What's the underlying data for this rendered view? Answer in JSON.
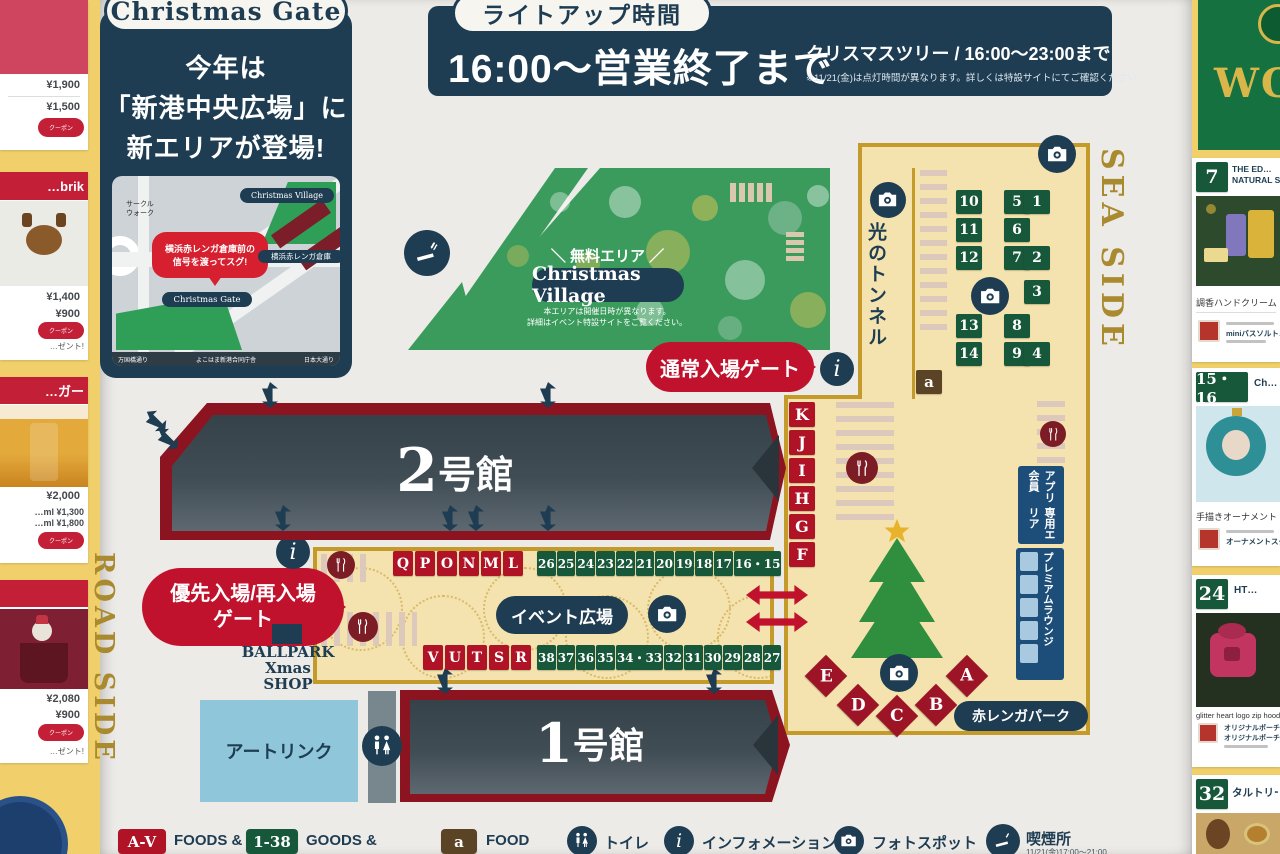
{
  "gate_intro": {
    "pill": "Christmas Gate",
    "line1": "今年は",
    "line2": "「新港中央広場」に",
    "line3": "新エリアが登場!"
  },
  "minimap": {
    "area1": "サークル",
    "area2": "ウォーク",
    "bubble1": "横浜赤レンガ倉庫前の",
    "bubble2": "信号を渡ってスグ!",
    "village": "Christmas Village",
    "warehouse": "横浜赤レンガ倉庫",
    "gate": "Christmas Gate",
    "street_left": "万国橋通り",
    "street_center": "よこはま新港合同庁舎",
    "street_right": "日本大通り"
  },
  "lightup": {
    "pill": "ライトアップ時間",
    "main": "16:00〜営業終了まで",
    "tree": "クリスマスツリー / 16:00〜23:00まで",
    "note": "※11/21(金)は点灯時間が異なります。詳しくは特設サイトにてご確認ください。"
  },
  "village": {
    "free": "＼ 無料エリア ／",
    "name": "Christmas Village",
    "note1": "本エリアは開催日時が異なります。",
    "note2": "詳細はイベント特設サイトをご覧ください。"
  },
  "gates": {
    "normal": "通常入場ゲート",
    "priority1": "優先入場/再入場",
    "priority2": "ゲート"
  },
  "areas": {
    "hall2_num": "2",
    "hall2_suffix": "号館",
    "hall1_num": "1",
    "hall1_suffix": "号館",
    "tunnel": "光のトンネル",
    "sea_side": "SEA SIDE",
    "road_side": "ROAD SIDE",
    "event_plaza": "イベント広場",
    "park": "赤レンガパーク",
    "ballpark1": "BALLPARK",
    "ballpark2": "Xmas SHOP",
    "art_rink": "アートリンク",
    "app1": "アプリ会員",
    "app2": "専用エリア",
    "premium": "プレミアムラウンジ",
    "a_box": "a"
  },
  "booths": {
    "seaside_grid": [
      "10",
      "5",
      "1",
      "11",
      "6",
      "",
      "12",
      "7",
      "2",
      "",
      "",
      "3",
      "13",
      "8",
      "",
      "14",
      "9",
      "4"
    ],
    "kf": [
      "K",
      "J",
      "I",
      "H",
      "G",
      "F"
    ],
    "ql": [
      "Q",
      "P",
      "O",
      "N",
      "M",
      "L"
    ],
    "top_numbers": [
      "26",
      "25",
      "24",
      "23",
      "22",
      "21",
      "20",
      "19",
      "18",
      "17",
      "16・15"
    ],
    "vr": [
      "V",
      "U",
      "T",
      "S",
      "R"
    ],
    "bottom_numbers": [
      "38",
      "37",
      "36",
      "35",
      "34・33",
      "32",
      "31",
      "30",
      "29",
      "28",
      "27"
    ],
    "diamonds": [
      "E",
      "D",
      "C",
      "B",
      "A"
    ]
  },
  "legend": {
    "foods_box": "A-V",
    "foods": "FOODS &",
    "goods_box": "1-38",
    "goods": "GOODS &",
    "food_box": "a",
    "food": "FOOD",
    "toilet": "トイレ",
    "info": "インフォメーション",
    "photo": "フォトスポット",
    "smoking": "喫煙所",
    "smoking_note": "11/21(金)17:00〜21:00"
  },
  "left_panel": {
    "card1": {
      "price1": "¥1,900",
      "price2": "¥1,500",
      "badge": "クーポン"
    },
    "card2": {
      "header": "…brik",
      "price1": "¥1,400",
      "price2": "¥900",
      "badge": "クーポン",
      "note": "…ゼント!"
    },
    "card3": {
      "header": "…ガー",
      "price1": "¥2,000",
      "size1": "…ml ¥1,300",
      "size2": "…ml ¥1,800",
      "badge": "クーポン"
    },
    "card4": {
      "header": "",
      "price1": "¥2,080",
      "price2": "¥900",
      "badge": "クーポン",
      "note": "…ゼント!"
    }
  },
  "right_panel": {
    "world_header": "WO",
    "cards": [
      {
        "num": "7",
        "title1": "THE ED…",
        "title2": "NATURAL S…",
        "caption": "調香ハンドクリーム",
        "logo_text": "miniバスソルト…",
        "logo_text2": ""
      },
      {
        "num": "15・16",
        "title1": "Ch…",
        "title2": "",
        "caption": "手描きオーナメント",
        "logo_text": "オーナメントスタン…",
        "logo_text2": ""
      },
      {
        "num": "24",
        "title1": "HT…",
        "title2": "",
        "caption": "glitter heart logo zip hood…",
        "logo_text": "オリジナルポーチ、",
        "logo_text2": "オリジナルポーチ&ス…"
      },
      {
        "num": "32",
        "title1": "タルトリー…",
        "title2": "",
        "caption": "",
        "logo_text": "",
        "logo_text2": ""
      }
    ]
  }
}
